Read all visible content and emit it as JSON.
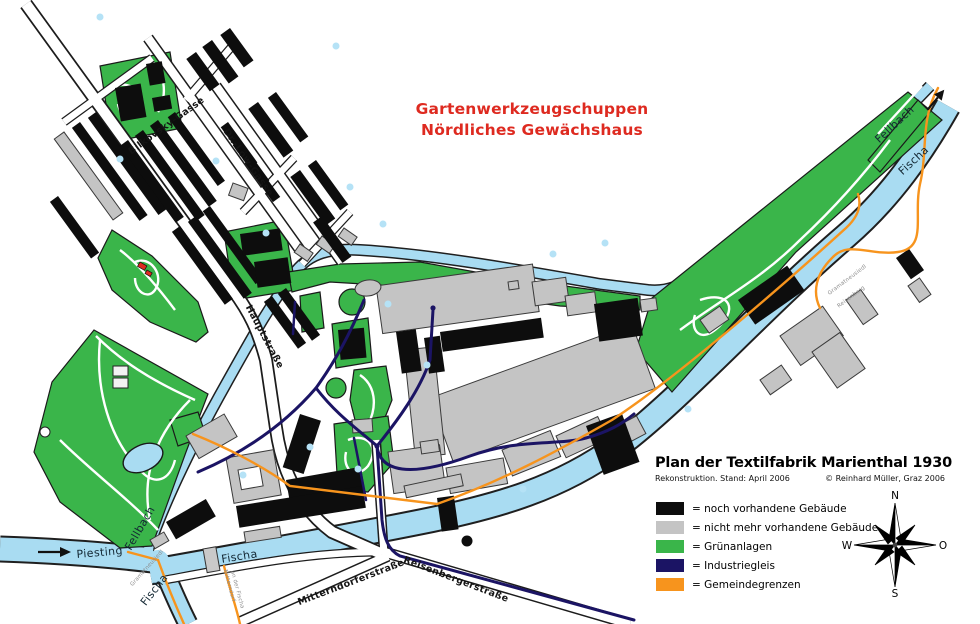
{
  "annotation": {
    "line1": "Gartenwerkzeugschuppen",
    "line2": "Nördliches Gewächshaus"
  },
  "title_block": {
    "title": "Plan der Textilfabrik Marienthal 1930",
    "subtitle_left": "Rekonstruktion. Stand: April 2006",
    "subtitle_right": "© Reinhard Müller, Graz 2006"
  },
  "legend": {
    "items": [
      {
        "color": "#0d0d0d",
        "label": "= noch vorhandene Gebäude"
      },
      {
        "color": "#c4c4c4",
        "label": "= nicht mehr vorhandene Gebäude"
      },
      {
        "color": "#3ab54a",
        "label": "= Grünanlagen"
      },
      {
        "color": "#1b1464",
        "label": "= Industriegleis"
      },
      {
        "color": "#f7941d",
        "label": "= Gemeindegrenzen"
      }
    ]
  },
  "compass": {
    "n": "N",
    "w": "W",
    "o": "O",
    "s": "S"
  },
  "map_labels": {
    "streets": {
      "bilkovsky": "Bilkovsky-Gasse",
      "dr_loew": "Dr.-Löw-Gasse",
      "hauptstrasse": "Hauptstraße",
      "mitterndorferstrasse": "Mitterndorferstraße",
      "reisenbergerstrasse": "Reisenbergerstraße"
    },
    "rivers": {
      "piesting": "Piesting",
      "fellbach_sw": "Fellbach",
      "fellbach_ne": "Fellbach",
      "fischa_s": "Fischa",
      "fischa_sw": "Fischa",
      "fischa_ne": "Fischa"
    },
    "boundaries": {
      "gramatneusiedl_ne": "Gramatneusiedl",
      "reisenberg_ne": "Reisenberg",
      "gramatneusiedl_sw": "Gramatneusiedl",
      "mitterndorf_line1": "Mitterndorf",
      "mitterndorf_line2": "an der Fischa"
    }
  },
  "colors": {
    "water": "#a9dcf2",
    "green": "#3ab54a",
    "gray_building": "#c4c4c4",
    "black_building": "#0d0d0d",
    "rail": "#1b1464",
    "boundary": "#f7941d",
    "annotation_red": "#de2a20"
  }
}
